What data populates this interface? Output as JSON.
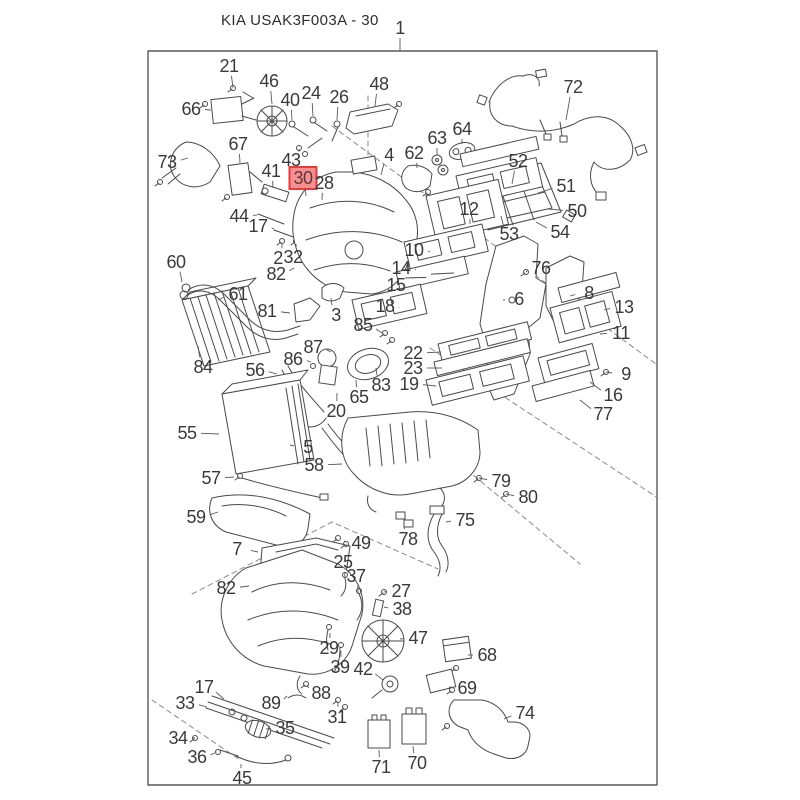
{
  "diagram": {
    "title": "KIA USAK3F003A - 30",
    "assembly_callout": "1",
    "highlighted_part": "30",
    "colors": {
      "line": "#4a4a4a",
      "label_text": "#3a3a3a",
      "highlight_fill": "#f59090",
      "highlight_border": "#e73c3c",
      "highlight_text": "#63343a",
      "background": "#ffffff"
    },
    "callouts": [
      {
        "n": "1",
        "x": 400,
        "y": 28,
        "tx": 400,
        "ty": 51
      },
      {
        "n": "21",
        "x": 229,
        "y": 66,
        "tx": 233,
        "ty": 88
      },
      {
        "n": "46",
        "x": 269,
        "y": 81,
        "tx": 272,
        "ty": 104
      },
      {
        "n": "66",
        "x": 191,
        "y": 109,
        "tx": 211,
        "ty": 110
      },
      {
        "n": "40",
        "x": 290,
        "y": 100,
        "tx": 292,
        "ty": 120
      },
      {
        "n": "24",
        "x": 311,
        "y": 93,
        "tx": 313,
        "ty": 116
      },
      {
        "n": "26",
        "x": 339,
        "y": 97,
        "tx": 337,
        "ty": 120
      },
      {
        "n": "48",
        "x": 379,
        "y": 84,
        "tx": 375,
        "ty": 106
      },
      {
        "n": "72",
        "x": 573,
        "y": 87,
        "tx": 566,
        "ty": 120
      },
      {
        "n": "73",
        "x": 167,
        "y": 162,
        "tx": 188,
        "ty": 158
      },
      {
        "n": "67",
        "x": 238,
        "y": 144,
        "tx": 240,
        "ty": 163
      },
      {
        "n": "4",
        "x": 389,
        "y": 155,
        "tx": 381,
        "ty": 175
      },
      {
        "n": "62",
        "x": 414,
        "y": 153,
        "tx": 417,
        "ty": 168
      },
      {
        "n": "63",
        "x": 437,
        "y": 138,
        "tx": 437,
        "ty": 155
      },
      {
        "n": "64",
        "x": 462,
        "y": 129,
        "tx": 462,
        "ty": 144
      },
      {
        "n": "52",
        "x": 518,
        "y": 161,
        "tx": 512,
        "ty": 184
      },
      {
        "n": "51",
        "x": 566,
        "y": 186,
        "tx": 538,
        "ty": 193
      },
      {
        "n": "50",
        "x": 577,
        "y": 211,
        "tx": 548,
        "ty": 209
      },
      {
        "n": "54",
        "x": 560,
        "y": 232,
        "tx": 536,
        "ty": 222
      },
      {
        "n": "53",
        "x": 509,
        "y": 234,
        "tx": 501,
        "ty": 216
      },
      {
        "n": "43",
        "x": 291,
        "y": 160,
        "tx": 299,
        "ty": 149
      },
      {
        "n": "41",
        "x": 271,
        "y": 171,
        "tx": 273,
        "ty": 188
      },
      {
        "n": "30",
        "x": 303,
        "y": 178,
        "tx": 306,
        "ty": 196,
        "hl": true
      },
      {
        "n": "28",
        "x": 324,
        "y": 183,
        "tx": 322,
        "ty": 200
      },
      {
        "n": "44",
        "x": 239,
        "y": 216,
        "tx": 257,
        "ty": 215
      },
      {
        "n": "17",
        "x": 258,
        "y": 226,
        "tx": 274,
        "ty": 229
      },
      {
        "n": "2",
        "x": 278,
        "y": 258,
        "tx": 282,
        "ty": 244
      },
      {
        "n": "32",
        "x": 293,
        "y": 257,
        "tx": 296,
        "ty": 244
      },
      {
        "n": "82",
        "x": 276,
        "y": 274,
        "tx": 294,
        "ty": 268
      },
      {
        "n": "60",
        "x": 176,
        "y": 262,
        "tx": 182,
        "ty": 282
      },
      {
        "n": "61",
        "x": 238,
        "y": 294,
        "tx": 218,
        "ty": 300
      },
      {
        "n": "84",
        "x": 203,
        "y": 367,
        "tx": 198,
        "ty": 346
      },
      {
        "n": "3",
        "x": 336,
        "y": 315,
        "tx": 331,
        "ty": 298
      },
      {
        "n": "12",
        "x": 469,
        "y": 209,
        "tx": 470,
        "ty": 224
      },
      {
        "n": "10",
        "x": 414,
        "y": 250,
        "tx": 430,
        "ty": 252
      },
      {
        "n": "14",
        "x": 401,
        "y": 268,
        "tx": 416,
        "ty": 270
      },
      {
        "n": "15",
        "x": 396,
        "y": 285,
        "tx": 411,
        "ty": 287
      },
      {
        "n": "18",
        "x": 385,
        "y": 306,
        "tx": 399,
        "ty": 308
      },
      {
        "n": "76",
        "x": 541,
        "y": 268,
        "tx": 526,
        "ty": 272
      },
      {
        "n": "6",
        "x": 519,
        "y": 299,
        "tx": 503,
        "ty": 300
      },
      {
        "n": "8",
        "x": 589,
        "y": 293,
        "tx": 570,
        "ty": 296
      },
      {
        "n": "13",
        "x": 624,
        "y": 307,
        "tx": 604,
        "ty": 310
      },
      {
        "n": "11",
        "x": 621,
        "y": 333,
        "tx": 600,
        "ty": 334
      },
      {
        "n": "9",
        "x": 626,
        "y": 374,
        "tx": 606,
        "ty": 372
      },
      {
        "n": "16",
        "x": 613,
        "y": 395,
        "tx": 590,
        "ty": 382
      },
      {
        "n": "77",
        "x": 603,
        "y": 414,
        "tx": 580,
        "ty": 400
      },
      {
        "n": "81",
        "x": 267,
        "y": 311,
        "tx": 290,
        "ty": 313
      },
      {
        "n": "85",
        "x": 363,
        "y": 325,
        "tx": 382,
        "ty": 333
      },
      {
        "n": "87",
        "x": 313,
        "y": 347,
        "tx": 331,
        "ty": 352
      },
      {
        "n": "86",
        "x": 293,
        "y": 359,
        "tx": 311,
        "ty": 362
      },
      {
        "n": "83",
        "x": 381,
        "y": 385,
        "tx": 376,
        "ty": 368
      },
      {
        "n": "65",
        "x": 359,
        "y": 397,
        "tx": 356,
        "ty": 380
      },
      {
        "n": "20",
        "x": 336,
        "y": 411,
        "tx": 337,
        "ty": 393
      },
      {
        "n": "22",
        "x": 413,
        "y": 353,
        "tx": 441,
        "ty": 352
      },
      {
        "n": "23",
        "x": 413,
        "y": 368,
        "tx": 442,
        "ty": 368
      },
      {
        "n": "19",
        "x": 409,
        "y": 384,
        "tx": 436,
        "ty": 386
      },
      {
        "n": "56",
        "x": 255,
        "y": 370,
        "tx": 277,
        "ty": 374
      },
      {
        "n": "55",
        "x": 187,
        "y": 433,
        "tx": 219,
        "ty": 434
      },
      {
        "n": "5",
        "x": 308,
        "y": 447,
        "tx": 290,
        "ty": 445
      },
      {
        "n": "58",
        "x": 314,
        "y": 465,
        "tx": 342,
        "ty": 464
      },
      {
        "n": "57",
        "x": 211,
        "y": 478,
        "tx": 234,
        "ty": 477
      },
      {
        "n": "59",
        "x": 196,
        "y": 517,
        "tx": 218,
        "ty": 512
      },
      {
        "n": "7",
        "x": 237,
        "y": 549,
        "tx": 258,
        "ty": 552
      },
      {
        "n": "49",
        "x": 361,
        "y": 543,
        "tx": 344,
        "ty": 541
      },
      {
        "n": "25",
        "x": 343,
        "y": 562,
        "tx": 345,
        "ty": 579
      },
      {
        "n": "37",
        "x": 356,
        "y": 576,
        "tx": 358,
        "ty": 593
      },
      {
        "n": "27",
        "x": 401,
        "y": 591,
        "tx": 384,
        "ty": 592
      },
      {
        "n": "38",
        "x": 402,
        "y": 609,
        "tx": 384,
        "ty": 607
      },
      {
        "n": "47",
        "x": 418,
        "y": 638,
        "tx": 400,
        "ty": 639
      },
      {
        "n": "82",
        "x": 226,
        "y": 588,
        "tx": 249,
        "ty": 586
      },
      {
        "n": "29",
        "x": 329,
        "y": 648,
        "tx": 330,
        "ty": 633
      },
      {
        "n": "39",
        "x": 340,
        "y": 667,
        "tx": 341,
        "ty": 651
      },
      {
        "n": "42",
        "x": 363,
        "y": 669,
        "tx": 383,
        "ty": 680
      },
      {
        "n": "88",
        "x": 321,
        "y": 693,
        "tx": 307,
        "ty": 685
      },
      {
        "n": "89",
        "x": 271,
        "y": 703,
        "tx": 287,
        "ty": 696
      },
      {
        "n": "31",
        "x": 337,
        "y": 717,
        "tx": 338,
        "ty": 702
      },
      {
        "n": "68",
        "x": 487,
        "y": 655,
        "tx": 468,
        "ty": 655
      },
      {
        "n": "69",
        "x": 467,
        "y": 688,
        "tx": 449,
        "ty": 687
      },
      {
        "n": "74",
        "x": 525,
        "y": 713,
        "tx": 504,
        "ty": 719
      },
      {
        "n": "17",
        "x": 204,
        "y": 687,
        "tx": 224,
        "ty": 699
      },
      {
        "n": "33",
        "x": 185,
        "y": 703,
        "tx": 207,
        "ty": 707
      },
      {
        "n": "34",
        "x": 178,
        "y": 738,
        "tx": 195,
        "ty": 738
      },
      {
        "n": "36",
        "x": 197,
        "y": 757,
        "tx": 215,
        "ty": 753
      },
      {
        "n": "35",
        "x": 285,
        "y": 728,
        "tx": 266,
        "ty": 729
      },
      {
        "n": "45",
        "x": 242,
        "y": 778,
        "tx": 241,
        "ty": 764
      },
      {
        "n": "71",
        "x": 381,
        "y": 767,
        "tx": 379,
        "ty": 750
      },
      {
        "n": "70",
        "x": 417,
        "y": 763,
        "tx": 413,
        "ty": 746
      },
      {
        "n": "79",
        "x": 501,
        "y": 481,
        "tx": 479,
        "ty": 478
      },
      {
        "n": "80",
        "x": 528,
        "y": 497,
        "tx": 506,
        "ty": 494
      },
      {
        "n": "75",
        "x": 465,
        "y": 520,
        "tx": 446,
        "ty": 522
      },
      {
        "n": "78",
        "x": 408,
        "y": 539,
        "tx": 404,
        "ty": 524
      }
    ]
  }
}
